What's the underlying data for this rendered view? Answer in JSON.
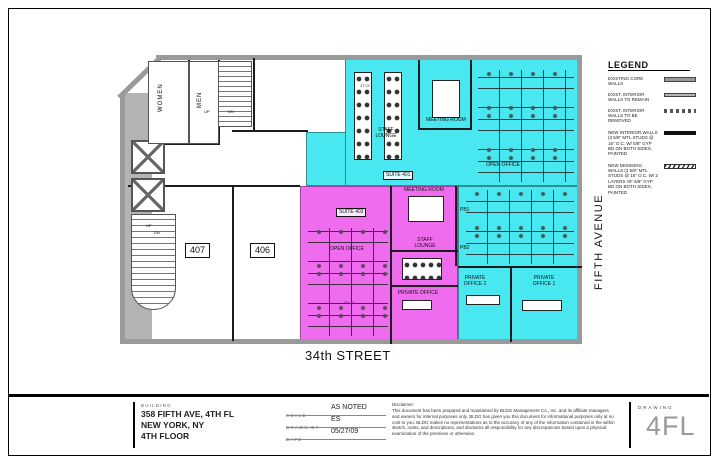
{
  "colors": {
    "suite_401_fill": "#49e7ef",
    "suite_403_fill": "#ef6cee",
    "wall_gray": "#9a9a9a"
  },
  "streets": {
    "south": "34th STREET",
    "east": "FIFTH AVENUE"
  },
  "rooms": {
    "women": "WOMEN",
    "men": "MEN",
    "up": "UP",
    "dn": "DN",
    "room_407": "407",
    "room_406": "406",
    "suite_401": "SUITE 401",
    "suite_403": "SUITE 403",
    "cyan_staff_lounge": "STAFF LOUNGE",
    "cyan_meeting_room": "MEETING ROOM",
    "cyan_open_office": "OPEN OFFICE",
    "pink_meeting_room": "MEETING ROOM",
    "pink_open_office": "OPEN OFFICE",
    "pink_staff_lounge": "STAFF LOUNGE",
    "pink_private_office": "PRIVATE OFFICE",
    "pb1": "PB1",
    "pb2": "PB2",
    "private_office_1": "PRIVATE OFFICE 1",
    "private_office_2": "PRIVATE OFFICE 2"
  },
  "dims": {
    "staff_lounge_width": "17'-0\"",
    "open_office_width": "22'-4\""
  },
  "legend": {
    "title": "LEGEND",
    "items": [
      {
        "label": "EXISTING CORE WALLS",
        "swatch": "core"
      },
      {
        "label": "EXIST. INTERIOR WALLS TO REMAIN",
        "swatch": "remain"
      },
      {
        "label": "EXIST. INTERIOR WALLS TO BE REMOVED",
        "swatch": "removed"
      },
      {
        "label": "NEW INTERIOR WALLS (3 5/8\" MTL STUDS @ 16\" O.C. W/ 5/8\" GYP BD ON BOTH SIDES, PAINTED",
        "swatch": "new-interior"
      },
      {
        "label": "NEW DEMISING WALLS (3 5/8\" MTL STUDS @ 16\" O.C. W/ 2 LAYERS OF 5/8\" GYP BD ON BOTH SIDES, PAINTED",
        "swatch": "new-demising"
      }
    ]
  },
  "title_block": {
    "building_label": "BUILDING",
    "address_line1": "358 FIFTH AVE, 4TH FL",
    "address_line2": "NEW YORK, NY",
    "address_line3": "4TH FLOOR",
    "scale_label": "SCALE",
    "scale_value": "AS NOTED",
    "drawn_by_label": "DRAWN BY",
    "drawn_by_value": "ES",
    "date_label": "DATE",
    "date_value": "05/27/09",
    "disclaimer_title": "Disclaimer:",
    "disclaimer_text": "This document has been prepared and maintained by BLDG Management Co., Inc. and its affiliate managers and owners for internal purposes only.  BLDG has given you this document for informational purposes only at no cost to you.  BLDG makes no representations as to the accuracy of any of the information contained in the within sketch, notes, and descriptions, and disclaims all responsibility for any discrepancies based upon a physical examination of the premises or otherwise.",
    "drawing_label": "DRAWING",
    "drawing_number": "4FL"
  }
}
